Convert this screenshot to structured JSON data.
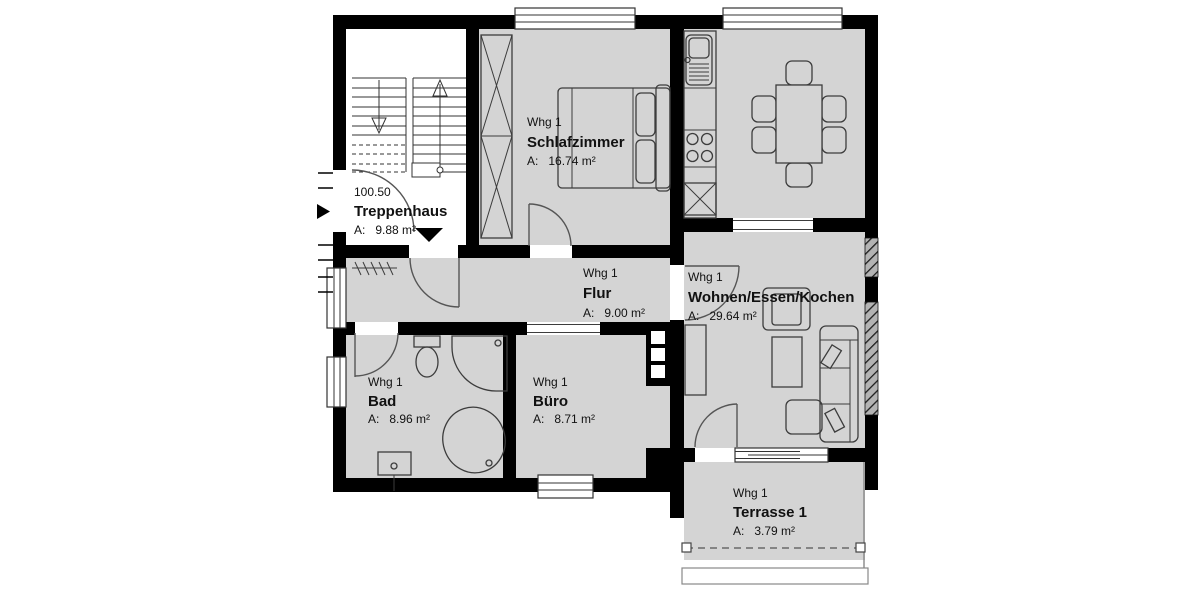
{
  "plan": {
    "colors": {
      "wall": "#000000",
      "floor": "#d4d4d4",
      "stairwell_floor": "#ffffff",
      "background": "#ffffff",
      "line": "#3c3c3c"
    },
    "stairwell": {
      "level": "100.50",
      "name": "Treppenhaus",
      "area": "A:   9.88 m²"
    },
    "rooms": {
      "schlafzimmer": {
        "unit": "Whg 1",
        "name": "Schlafzimmer",
        "area": "A:   16.74 m²"
      },
      "flur": {
        "unit": "Whg 1",
        "name": "Flur",
        "area": "A:   9.00 m²"
      },
      "wohnen": {
        "unit": "Whg 1",
        "name": "Wohnen/Essen/Kochen",
        "area": "A:   29.64 m²"
      },
      "bad": {
        "unit": "Whg 1",
        "name": "Bad",
        "area": "A:   8.96 m²"
      },
      "buero": {
        "unit": "Whg 1",
        "name": "Büro",
        "area": "A:   8.71 m²"
      },
      "terrasse": {
        "unit": "Whg 1",
        "name": "Terrasse 1",
        "area": "A:   3.79 m²"
      }
    }
  }
}
